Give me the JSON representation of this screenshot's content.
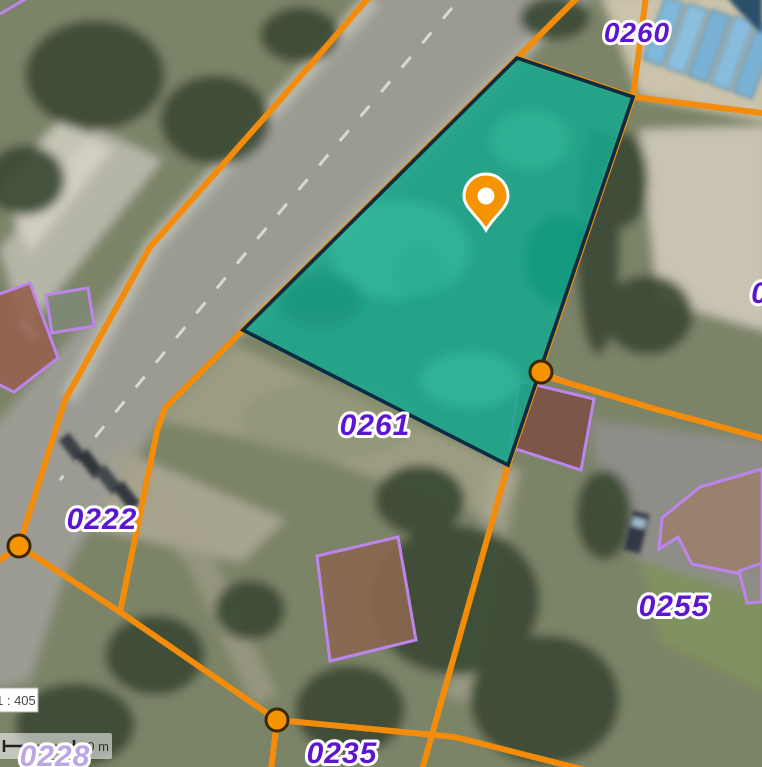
{
  "map": {
    "type": "cadastral-aerial-map",
    "parcels": {
      "labels": [
        {
          "text": "0260"
        },
        {
          "text": "0261"
        },
        {
          "text": "0222"
        },
        {
          "text": "0255"
        },
        {
          "text": "0235"
        },
        {
          "text": "0228"
        },
        {
          "text": "0"
        }
      ]
    },
    "selected_parcel": {
      "fill": "#18A78D",
      "outline": "#0C2C44"
    },
    "marker": {
      "name": "location-pin",
      "color": "#F59300"
    },
    "scale": {
      "ratio": "1 : 405",
      "bar_label": "10 m"
    },
    "colors": {
      "boundary": "#F28C0A",
      "node_fill": "#F59300",
      "node_stroke": "#3A2800",
      "parcel_label": "#5C16D2",
      "parcel_label_muted": "#BCA6E6",
      "building_outline": "#BC85EC",
      "building_edge_highlight": "#FF8FD0"
    }
  }
}
